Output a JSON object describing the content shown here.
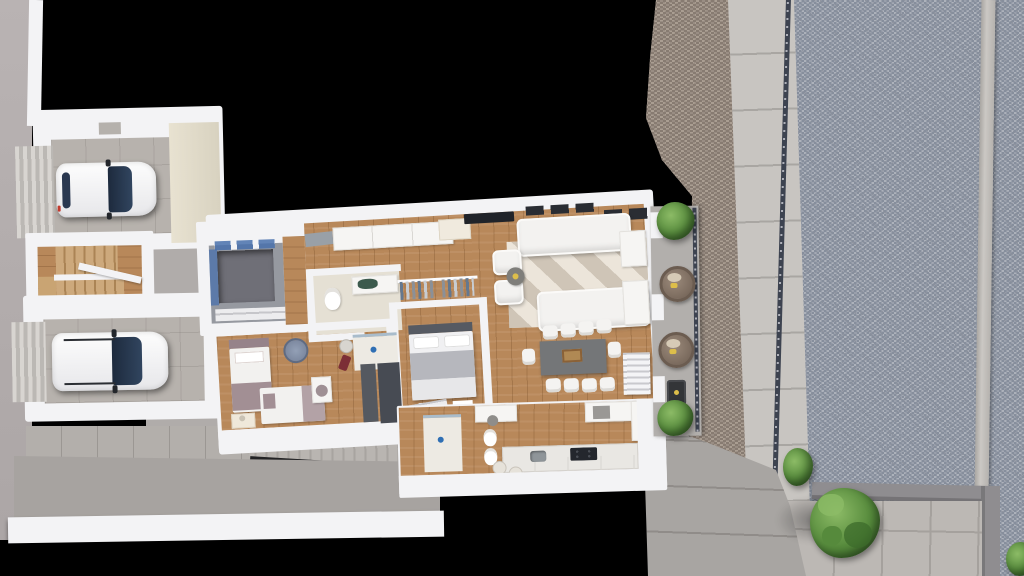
{
  "scene": {
    "type": "3d-floor-plan-render",
    "view": "top-down aerial",
    "background": "#000000",
    "description": "Rendered top view of a single-storey apartment level with two garages, stair hall, bedrooms, bathrooms, open living-dining-kitchen, side balcony, public sidewalk, gravel lot and neighbouring patio with tree"
  },
  "colors": {
    "wall": "#f3f3f5",
    "wall-shade": "#d7d7db",
    "cream-wall": "#e8e2d1",
    "wood": "#b8885a",
    "garage-floor": "#b7b2ad",
    "courtyard": "#b0acaa",
    "driveway": "#a7a3a0",
    "apron": "#b3afab",
    "sidewalk": "#c8c5c1",
    "sidewalk-joint": "#a9a6a2",
    "gravel": "#9aa0ac",
    "gravel-dark": "#868e9c",
    "gravel-light": "#adb2bb",
    "cobble": "#998d83",
    "cobble-dark": "#877b71",
    "cobble-light": "#aa9e92",
    "walkway": "#a8a5a2",
    "patio": "#bcb8b4",
    "patio-joint": "#a5a19d",
    "lwall": "#8f8d90",
    "fence": "#3d4350",
    "glass-blue": "#5b82b5",
    "void-floor": "#6f6f77",
    "bath-floor": "#e5e0d4",
    "shower-floor": "#edeae3",
    "marble": "#e9e7e3",
    "cooktop": "#24272d",
    "tv": "#202329",
    "rug-light": "#ece5da",
    "rug-mid": "#cfc5b7",
    "table": "#747678",
    "bed-gray": "#b6b7bd",
    "headboard": "#565a62",
    "mauve": "#a28f94",
    "mauve-dark": "#96838a",
    "shelf-dark": "#474b53",
    "wardrobe-dark": "#555960",
    "green-dark": "#3c6b2b",
    "green": "#568a3c",
    "green-light": "#8cbb66",
    "wicker": "#8a7a6c",
    "wicker-dark": "#6b5c50",
    "cushion": "#d6cab6",
    "yellow": "#ddbe4a",
    "car-glass": "#263650",
    "maroon": "#7c2f36",
    "drain-blue": "#2f6fb4",
    "counter-green": "#3c5a4d",
    "steel": "#8f9599"
  },
  "house": {
    "rooms": [
      {
        "name": "garage-1",
        "floor": "concrete-tile",
        "contents": [
          "white-car",
          "roller-door-ramp",
          "cream-side-wall"
        ]
      },
      {
        "name": "garage-2",
        "floor": "concrete-tile",
        "contents": [
          "white-suv",
          "roller-door-ramp"
        ]
      },
      {
        "name": "stair-hall",
        "floor": "wood",
        "contents": [
          "l-shaped-wood-staircase",
          "landing"
        ]
      },
      {
        "name": "stair-void-landing",
        "contents": [
          "open-void",
          "blue-glass-balustrade",
          "wood-wardrobe"
        ]
      },
      {
        "name": "hallway",
        "floor": "wood",
        "contents": [
          "entry-doormat"
        ]
      },
      {
        "name": "bathroom-1",
        "floor": "beige-tile",
        "contents": [
          "toilet",
          "vanity-counter",
          "green-basin"
        ]
      },
      {
        "name": "wardrobe-corridor",
        "contents": [
          "two-clothes-rails-with-hanging-clothes"
        ]
      },
      {
        "name": "master-bedroom",
        "floor": "wood",
        "contents": [
          "double-bed-gray-duvet",
          "dark-headboard",
          "two-pillows"
        ]
      },
      {
        "name": "kids-bedroom",
        "floor": "wood",
        "contents": [
          "single-bed-vertical",
          "single-bed-horizontal",
          "round-blue-rug",
          "nightstand-lamp",
          "desk-chair"
        ]
      },
      {
        "name": "shower-room",
        "contents": [
          "glass-screen",
          "floor-drain",
          "laundry-basket",
          "maroon-towel"
        ]
      },
      {
        "name": "dressing-units",
        "contents": [
          "dark-wardrobe",
          "open-shelf-bookcase"
        ]
      },
      {
        "name": "living-room",
        "floor": "wood",
        "contents": [
          "two-white-sofas",
          "two-armchairs",
          "round-coffee-table",
          "geometric-rug",
          "tv",
          "sideboard",
          "wall-frames"
        ]
      },
      {
        "name": "dining-area",
        "contents": [
          "gray-table",
          "ten-white-chairs",
          "wood-centerpiece"
        ]
      },
      {
        "name": "kitchen",
        "contents": [
          "counter-with-sink-and-cooktop",
          "two-stools",
          "white-l-unit"
        ]
      },
      {
        "name": "bathroom-2",
        "contents": [
          "shower-drain",
          "toilet",
          "bidet",
          "vanity-stool"
        ]
      },
      {
        "name": "balcony",
        "floor": "concrete",
        "contents": [
          "dark-railing",
          "two-wicker-chairs",
          "bbq-grill",
          "three-planters",
          "two-green-bushes",
          "exit-steps"
        ]
      }
    ],
    "vehicles": [
      {
        "name": "car-1",
        "color": "white",
        "location": "garage-1"
      },
      {
        "name": "car-2",
        "color": "white",
        "location": "garage-2",
        "roof_rails": true
      }
    ]
  },
  "exterior": {
    "left": [
      "street-strip",
      "west-boundary-wall",
      "courtyard-path",
      "garage-apron",
      "exterior-ramp-stairs",
      "front-driveway",
      "south-boundary-wall"
    ],
    "right": [
      "cobblestone-yard",
      "public-sidewalk",
      "boundary-fence",
      "gravel-lot",
      "gravel-divider-wall",
      "retaining-l-wall",
      "neighbor-patio",
      "patio-tree",
      "fence-bush",
      "corner-bush",
      "garden-walkway"
    ]
  }
}
